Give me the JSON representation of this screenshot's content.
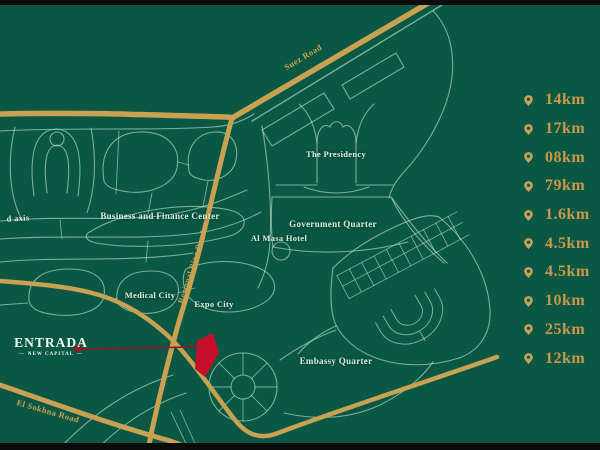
{
  "logo": {
    "name": "ENTRADA",
    "subtitle": "NEW CAPITAL",
    "flourish": "—"
  },
  "map": {
    "district_labels": [
      {
        "id": "axis-partial",
        "text": "d axis"
      },
      {
        "id": "business-finance-center",
        "text": "Business and Finance Center"
      },
      {
        "id": "the-presidency",
        "text": "The Presidency"
      },
      {
        "id": "government-quarter",
        "text": "Government Quarter"
      },
      {
        "id": "al-masa-hotel",
        "text": "Al Masa Hotel"
      },
      {
        "id": "medical-city",
        "text": "Medical City"
      },
      {
        "id": "expo-city",
        "text": "Expo City"
      },
      {
        "id": "embassy-quarter",
        "text": "Embassy Quarter"
      }
    ],
    "road_labels": [
      {
        "id": "suez-road",
        "text": "Suez Road"
      },
      {
        "id": "regional-ring-road",
        "text": "Regional Ring Road"
      },
      {
        "id": "el-sokhna-road",
        "text": "El Sokhna Road"
      }
    ],
    "colors": {
      "background": "#0a5743",
      "road_teal": "#bfe3d2",
      "road_gold": "#c9a152",
      "label_white": "#dcebe2",
      "distance_gold": "#c9984c",
      "marker_red": "#c50f2d",
      "arrow_red": "#9c1422",
      "letterbox_black": "#0b0b0b"
    }
  },
  "distances": {
    "icon": "map-pin",
    "items": [
      "14km",
      "17km",
      "08km",
      "79km",
      "1.6km",
      "4.5km",
      "4.5km",
      "10km",
      "25km",
      "12km"
    ]
  }
}
